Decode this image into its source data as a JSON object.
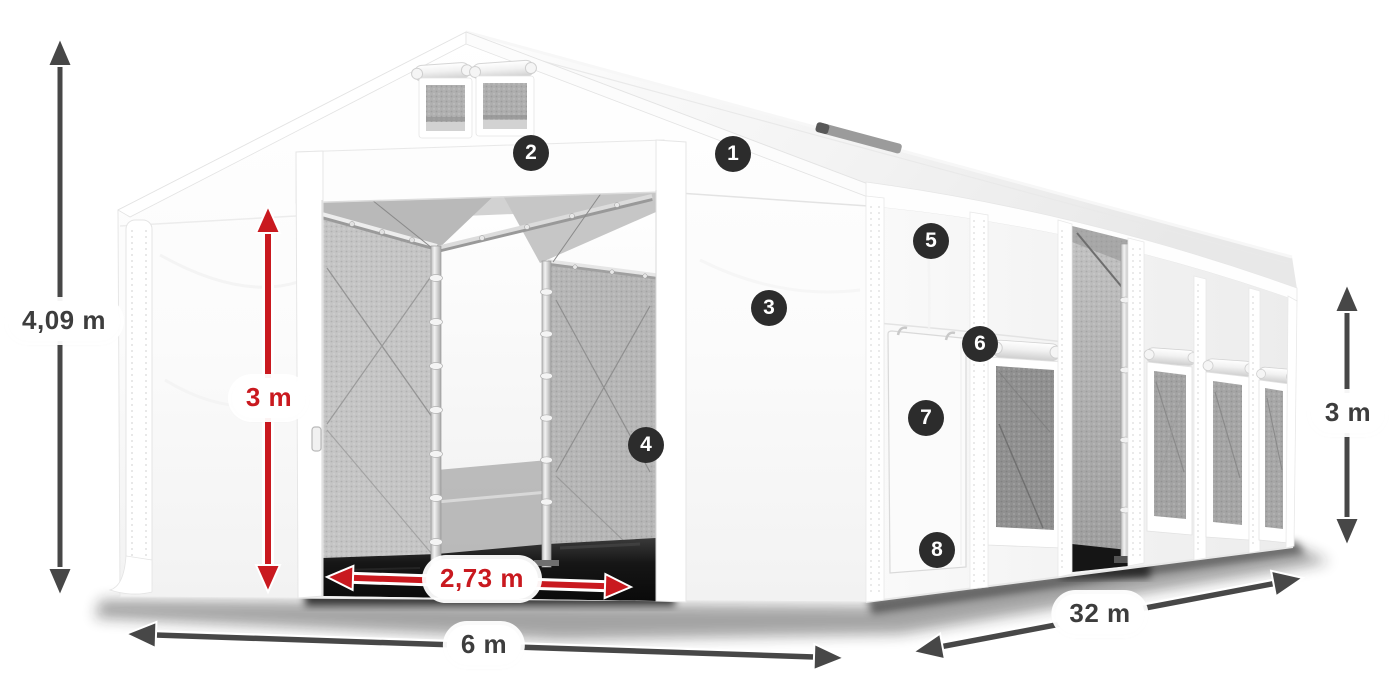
{
  "dimensions": {
    "total_height": "4,09 m",
    "entrance_height": "3 m",
    "entrance_width": "2,73 m",
    "front_width": "6 m",
    "side_length": "32 m",
    "side_wall_height": "3 m"
  },
  "callouts": [
    {
      "number": "1"
    },
    {
      "number": "2"
    },
    {
      "number": "3"
    },
    {
      "number": "4"
    },
    {
      "number": "5"
    },
    {
      "number": "6"
    },
    {
      "number": "7"
    },
    {
      "number": "8"
    }
  ],
  "colors": {
    "background": "#ffffff",
    "dimension_dark": "#474747",
    "dimension_red": "#c9191f",
    "pill_background": "#ffffff",
    "badge_background": "#2c2c2c",
    "badge_text": "#ffffff",
    "tent_white": "#ffffff",
    "mesh_gray": "#b5b5b5"
  }
}
